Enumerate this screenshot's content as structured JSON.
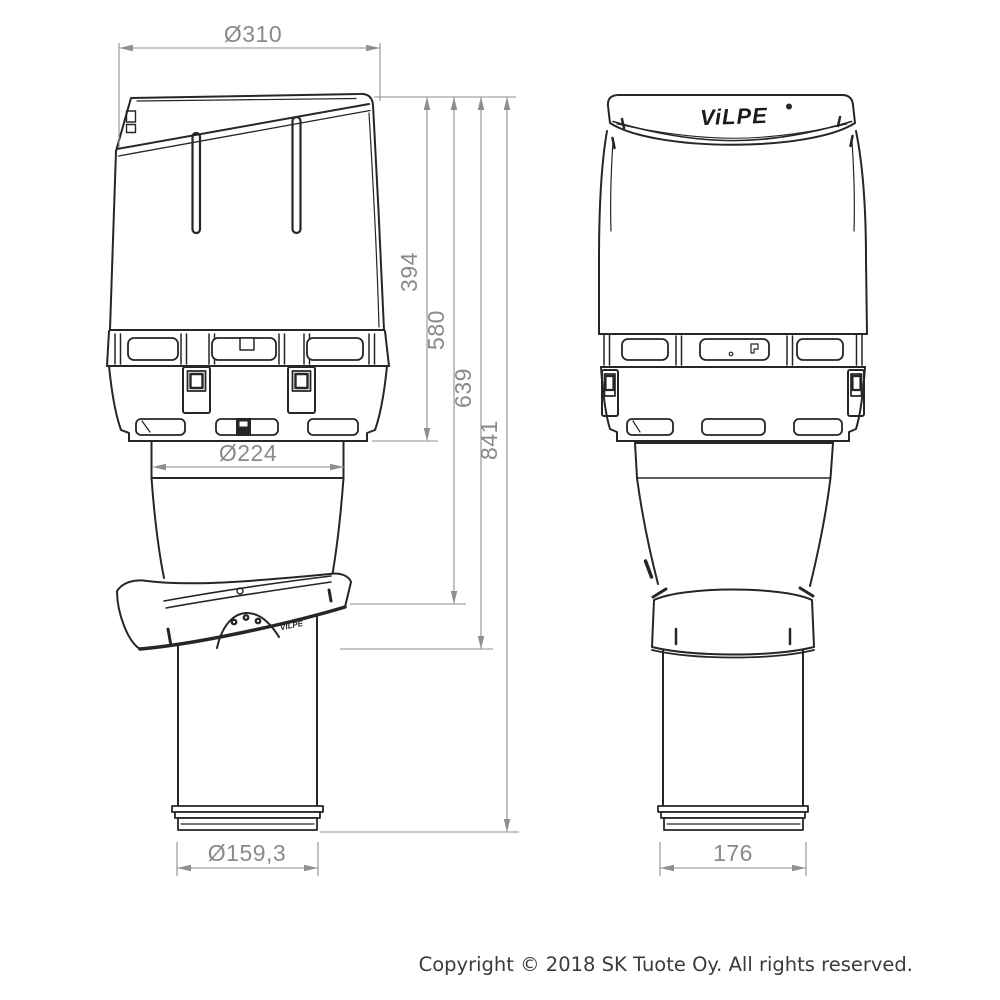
{
  "drawing": {
    "description": "Technical dimension drawing of a VILPE roof ventilation outlet, side view and front view",
    "views": [
      "side-view",
      "front-view"
    ],
    "colors": {
      "outline": "#262626",
      "dimension_lines": "#8f8f8f",
      "dimension_text": "#8a8a8a",
      "background": "#ffffff"
    },
    "dimensions": {
      "cap_diameter": "Ø310",
      "adapter_diameter": "Ø224",
      "pipe_diameter": "Ø159,3",
      "cap_height": "394",
      "flashing_top_height": "580",
      "flashing_bottom_height": "639",
      "total_height": "841",
      "front_pipe_width": "176"
    }
  },
  "brand": {
    "logo_text": "ViLPE",
    "flashing_text": "VILPE"
  },
  "footer": {
    "copyright": "Copyright © 2018 SK Tuote Oy. All rights reserved."
  }
}
